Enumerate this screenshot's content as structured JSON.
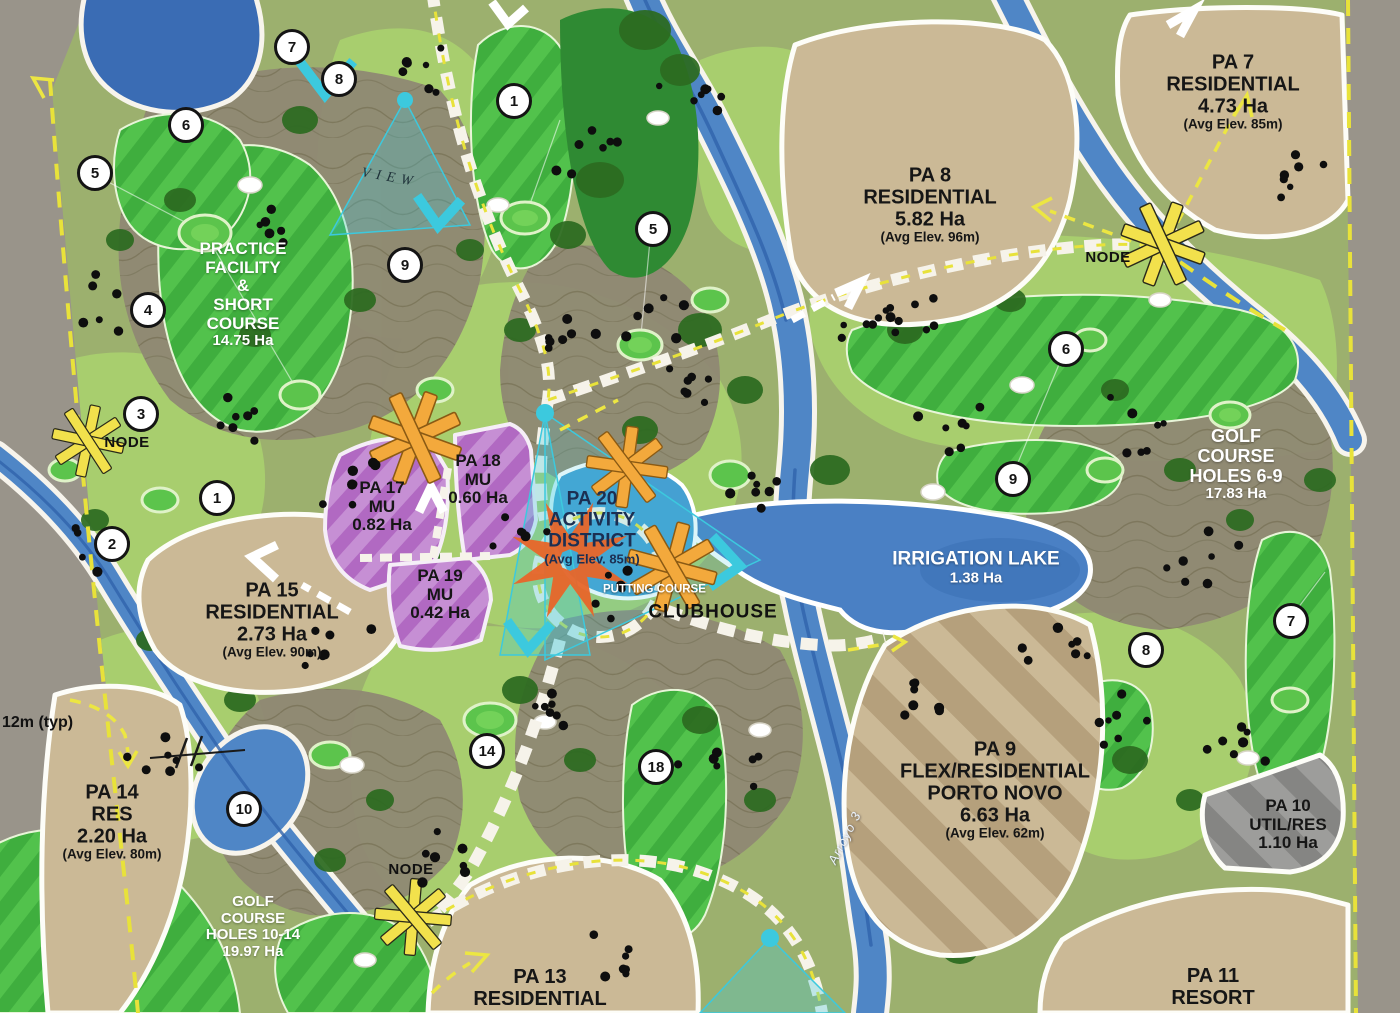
{
  "parcels": {
    "pa7": {
      "title": "PA 7",
      "use": "RESIDENTIAL",
      "area": "4.73 Ha",
      "elev": "(Avg Elev. 85m)"
    },
    "pa8": {
      "title": "PA 8",
      "use": "RESIDENTIAL",
      "area": "5.82 Ha",
      "elev": "(Avg Elev. 96m)"
    },
    "pa9": {
      "title": "PA 9",
      "use": "FLEX/RESIDENTIAL",
      "use2": "PORTO NOVO",
      "area": "6.63 Ha",
      "elev": "(Avg Elev. 62m)"
    },
    "pa10": {
      "title": "PA 10",
      "use": "UTIL/RES",
      "area": "1.10 Ha"
    },
    "pa11": {
      "title": "PA 11",
      "use": "RESORT"
    },
    "pa13": {
      "title": "PA 13",
      "use": "RESIDENTIAL"
    },
    "pa14": {
      "title": "PA 14",
      "use": "RES",
      "area": "2.20 Ha",
      "elev": "(Avg Elev. 80m)"
    },
    "pa15": {
      "title": "PA 15",
      "use": "RESIDENTIAL",
      "area": "2.73 Ha",
      "elev": "(Avg Elev. 90m)"
    },
    "pa17": {
      "title": "PA 17",
      "use": "MU",
      "area": "0.82 Ha"
    },
    "pa18": {
      "title": "PA 18",
      "use": "MU",
      "area": "0.60 Ha"
    },
    "pa19": {
      "title": "PA 19",
      "use": "MU",
      "area": "0.42 Ha"
    },
    "pa20": {
      "title": "PA 20",
      "use": "ACTIVITY",
      "use2": "DISTRICT",
      "elev": "(Avg Elev. 85m)"
    }
  },
  "golf": {
    "practice": {
      "l1": "PRACTICE",
      "l2": "FACILITY",
      "l3": "&",
      "l4": "SHORT",
      "l5": "COURSE",
      "area": "14.75 Ha"
    },
    "holes_6_9": {
      "l1": "GOLF",
      "l2": "COURSE",
      "l3": "HOLES 6-9",
      "area": "17.83 Ha"
    },
    "holes_10_14": {
      "l1": "GOLF",
      "l2": "COURSE",
      "l3": "HOLES 10-14",
      "area": "19.97 Ha"
    }
  },
  "features": {
    "irrigation_lake": {
      "name": "IRRIGATION LAKE",
      "area": "1.38 Ha"
    },
    "clubhouse": "CLUBHOUSE",
    "putting": {
      "l1": "PUTTING",
      "l2": "COURSE"
    },
    "view": "VIEW",
    "node": "NODE",
    "dimension": "12m (typ)",
    "arroyo": "Arroyo 3"
  },
  "hole_markers": [
    "7",
    "8",
    "6",
    "5",
    "1",
    "9",
    "5",
    "4",
    "3",
    "1",
    "2",
    "6",
    "9",
    "7",
    "8",
    "14",
    "18",
    "10"
  ],
  "colors": {
    "fairway": "#3fae3e",
    "rough": "#a8ce6e",
    "terrain": "#8f8873",
    "water": "#4f86c6",
    "parcel_tan": "#cbb996",
    "mixed_use": "#b169c2",
    "node_yellow": "#f2e14c",
    "node_orange": "#f3a93c",
    "view_cyan": "#3cc9de",
    "boundary_yellow": "#e8e23a"
  }
}
